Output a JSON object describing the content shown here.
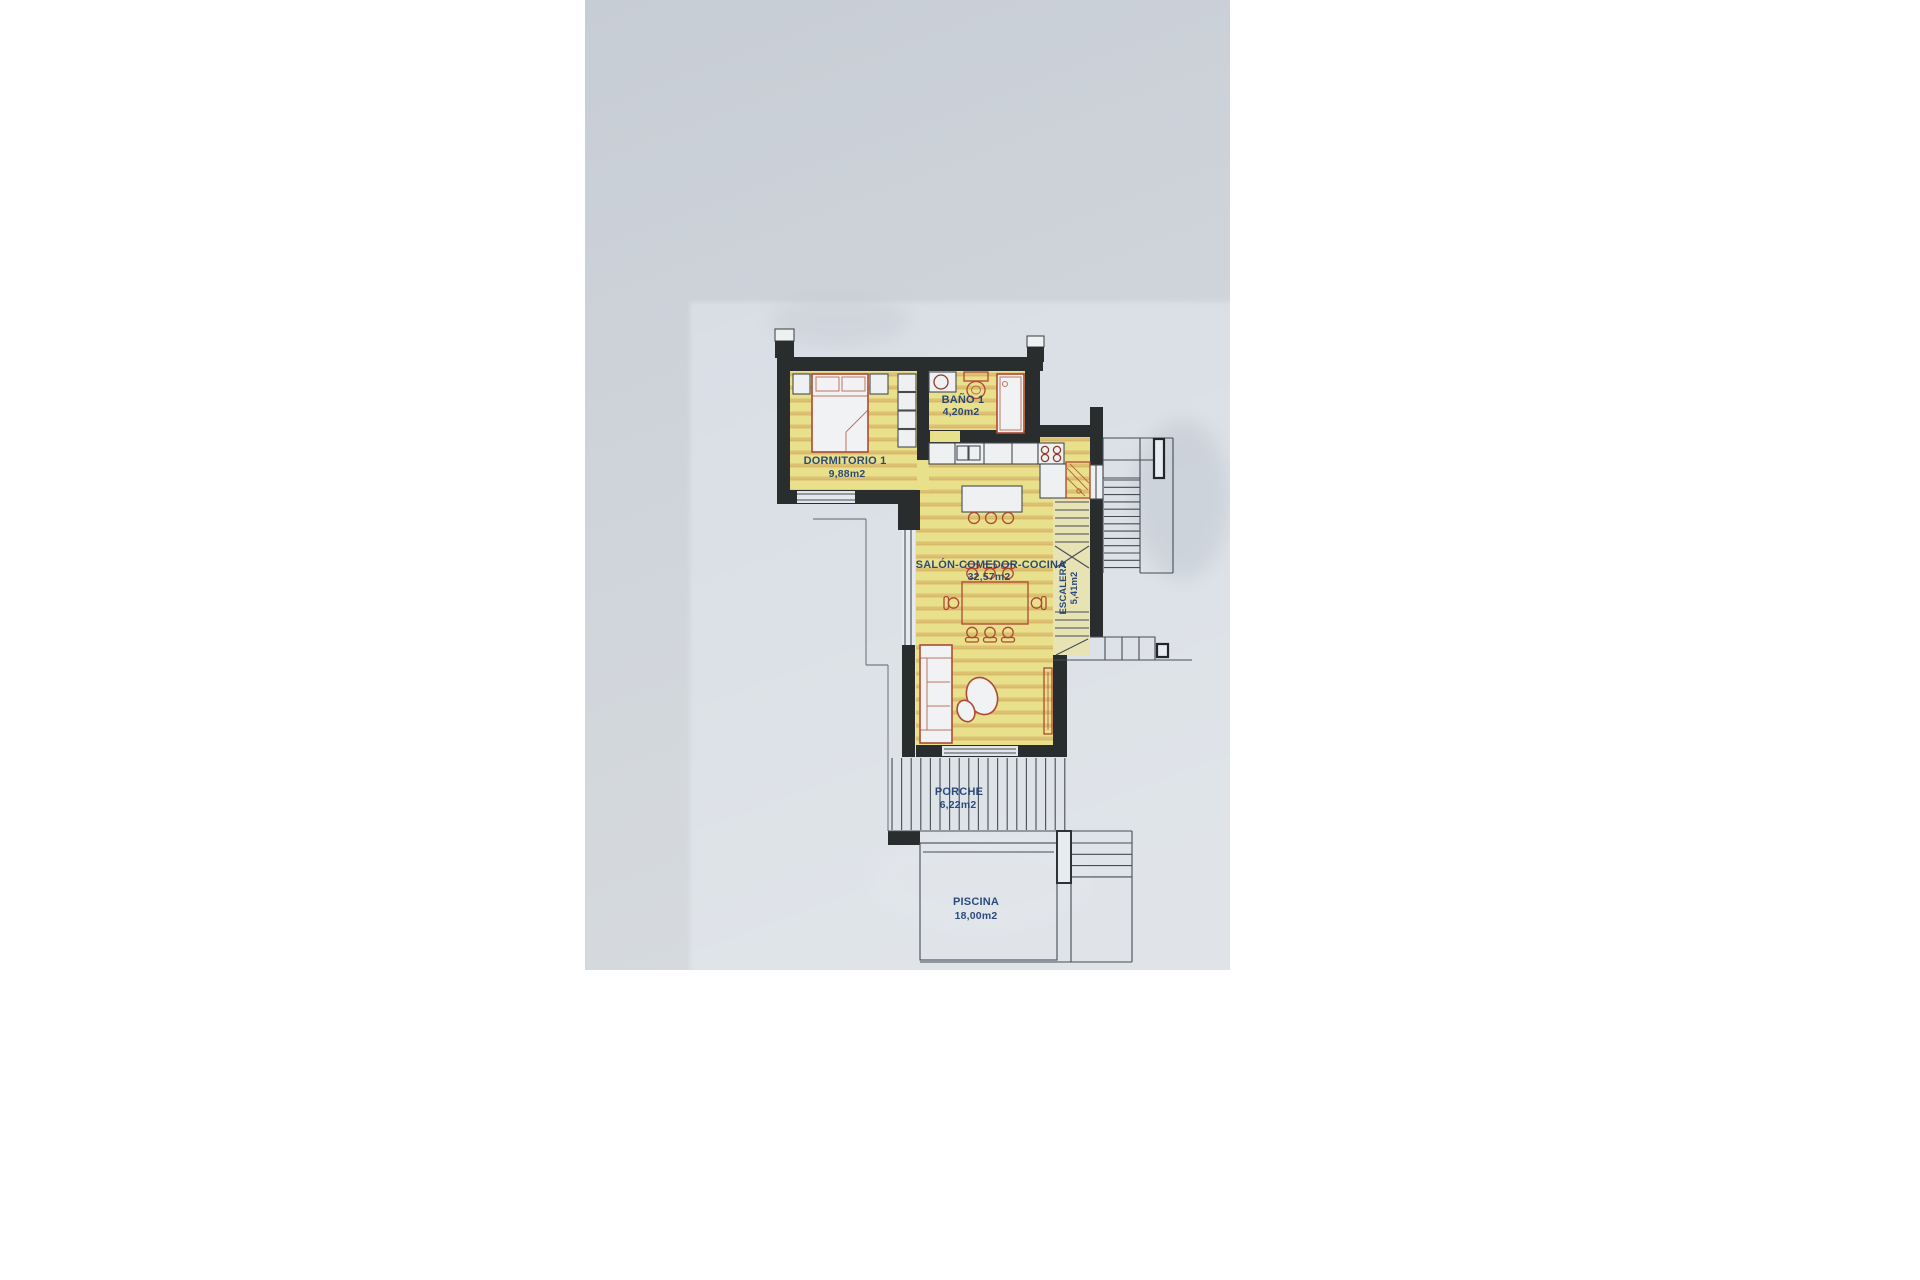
{
  "floor_plan": {
    "rooms": [
      {
        "id": "dormitorio1",
        "name": "DORMITORIO  1",
        "area": "9,88m2"
      },
      {
        "id": "bano1",
        "name": "BAÑO  1",
        "area": "4,20m2"
      },
      {
        "id": "salon",
        "name": "SALÓN-COMEDOR-COCINA",
        "area": "32,57m2"
      },
      {
        "id": "escalera",
        "name": "ESCALERA",
        "area": "5,41m2"
      },
      {
        "id": "porche",
        "name": "PORCHE",
        "area": "6,22m2"
      },
      {
        "id": "piscina",
        "name": "PISCINA",
        "area": "18,00m2"
      }
    ],
    "palette": {
      "wall": "#2a2d2d",
      "line": "#454c53",
      "furniture": "#ad4a33",
      "label": "#1c3e75",
      "room_fill": "#e9e08c",
      "room_hatch": "#d9bc6b",
      "paper": "#dbe0e7",
      "photo_bg": "#cbd1d8"
    }
  }
}
